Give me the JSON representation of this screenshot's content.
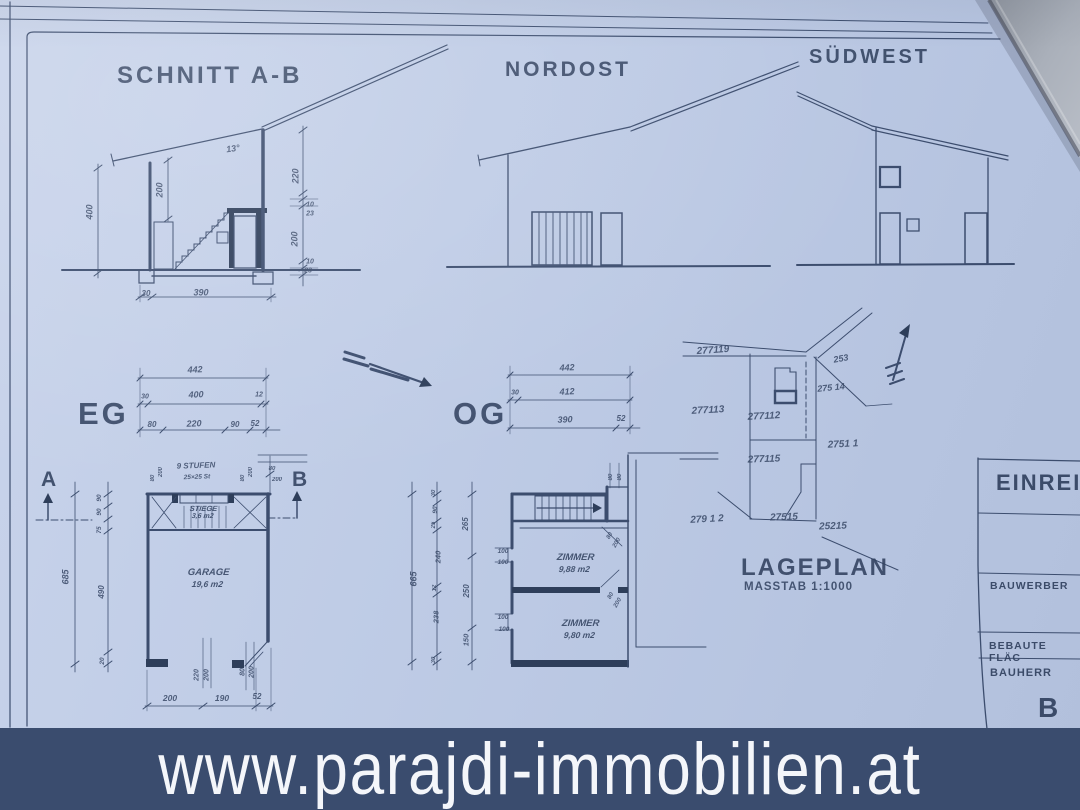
{
  "colors": {
    "paper": "#bfcce6",
    "ink": "#3c4d6e",
    "wall": "#2e3e5a",
    "banner_bg": "#3a4c6e",
    "banner_text": "#f4f6fa",
    "overlay_sheet": "#a7adb8"
  },
  "banner": {
    "url": "www.parajdi-immobilien.at"
  },
  "drawings": {
    "section": {
      "title": "SCHNITT A-B"
    },
    "nordost": {
      "title": "NORDOST"
    },
    "suedwest": {
      "title": "SÜDWEST"
    },
    "eg": {
      "title": "EG"
    },
    "og": {
      "title": "OG"
    },
    "lageplan": {
      "title": "LAGEPLAN",
      "scale": "MASSTAB 1:1000"
    }
  },
  "rooms": {
    "garage": {
      "name": "GARAGE",
      "area": "19,6 m2"
    },
    "stiege": {
      "name": "STIEGE",
      "area": "3,6 m2"
    },
    "zimmer1": {
      "name": "ZIMMER",
      "area": "9,88 m2"
    },
    "zimmer2": {
      "name": "ZIMMER",
      "area": "9,80 m2"
    }
  },
  "section_marks": {
    "a": "A",
    "b": "B"
  },
  "titleblock": {
    "header": "EINREIC",
    "bauwerber": "BAUWERBER",
    "bebaute": "BEBAUTE FLÄC",
    "bauherr": "BAUHERR",
    "partial_b": "B"
  },
  "annotations": [
    {
      "t": "13°",
      "x": 233,
      "y": 149,
      "r": -8,
      "s": 9
    },
    {
      "t": "400",
      "x": 90,
      "y": 212,
      "r": -90,
      "s": 9
    },
    {
      "t": "200",
      "x": 160,
      "y": 190,
      "r": -90,
      "s": 9
    },
    {
      "t": "220",
      "x": 296,
      "y": 176,
      "r": -90,
      "s": 9
    },
    {
      "t": "10",
      "x": 310,
      "y": 205,
      "r": 0,
      "s": 7
    },
    {
      "t": "23",
      "x": 310,
      "y": 214,
      "r": 0,
      "s": 7
    },
    {
      "t": "200",
      "x": 295,
      "y": 239,
      "r": -90,
      "s": 9
    },
    {
      "t": "10",
      "x": 310,
      "y": 262,
      "r": 0,
      "s": 7
    },
    {
      "t": "23",
      "x": 308,
      "y": 271,
      "r": 0,
      "s": 7
    },
    {
      "t": "30",
      "x": 146,
      "y": 294,
      "r": 0,
      "s": 8
    },
    {
      "t": "390",
      "x": 201,
      "y": 293,
      "r": 0,
      "s": 9
    },
    {
      "t": "442",
      "x": 195,
      "y": 370,
      "r": -2,
      "s": 9
    },
    {
      "t": "30",
      "x": 145,
      "y": 397,
      "r": 0,
      "s": 7
    },
    {
      "t": "400",
      "x": 196,
      "y": 395,
      "r": -2,
      "s": 9
    },
    {
      "t": "12",
      "x": 259,
      "y": 395,
      "r": 0,
      "s": 7
    },
    {
      "t": "80",
      "x": 152,
      "y": 425,
      "r": 0,
      "s": 8
    },
    {
      "t": "220",
      "x": 194,
      "y": 424,
      "r": -2,
      "s": 9
    },
    {
      "t": "90",
      "x": 235,
      "y": 425,
      "r": 0,
      "s": 8
    },
    {
      "t": "52",
      "x": 255,
      "y": 424,
      "r": 0,
      "s": 8
    },
    {
      "t": "9 STUFEN",
      "x": 196,
      "y": 466,
      "r": -2,
      "s": 8
    },
    {
      "t": "25×25 St",
      "x": 197,
      "y": 478,
      "r": -2,
      "s": 6.5
    },
    {
      "t": "80",
      "x": 153,
      "y": 478,
      "r": -90,
      "s": 6
    },
    {
      "t": "200",
      "x": 161,
      "y": 472,
      "r": -90,
      "s": 6
    },
    {
      "t": "80",
      "x": 243,
      "y": 478,
      "r": -90,
      "s": 6
    },
    {
      "t": "200",
      "x": 251,
      "y": 472,
      "r": -90,
      "s": 6
    },
    {
      "t": "80",
      "x": 272,
      "y": 469,
      "r": 0,
      "s": 6
    },
    {
      "t": "200",
      "x": 277,
      "y": 480,
      "r": 0,
      "s": 6
    },
    {
      "t": "685",
      "x": 66,
      "y": 577,
      "r": -90,
      "s": 9
    },
    {
      "t": "90",
      "x": 100,
      "y": 498,
      "r": -90,
      "s": 6.5
    },
    {
      "t": "90",
      "x": 100,
      "y": 512,
      "r": -90,
      "s": 6.5
    },
    {
      "t": "75",
      "x": 100,
      "y": 530,
      "r": -90,
      "s": 6.5
    },
    {
      "t": "490",
      "x": 102,
      "y": 592,
      "r": -90,
      "s": 8
    },
    {
      "t": "20",
      "x": 103,
      "y": 661,
      "r": -90,
      "s": 6.5
    },
    {
      "t": "220",
      "x": 197,
      "y": 675,
      "r": -90,
      "s": 7
    },
    {
      "t": "200",
      "x": 207,
      "y": 675,
      "r": -90,
      "s": 7
    },
    {
      "t": "80",
      "x": 243,
      "y": 672,
      "r": -90,
      "s": 7
    },
    {
      "t": "200",
      "x": 252,
      "y": 672,
      "r": -90,
      "s": 7
    },
    {
      "t": "200",
      "x": 170,
      "y": 698,
      "r": 0,
      "s": 8.5
    },
    {
      "t": "190",
      "x": 222,
      "y": 698,
      "r": 0,
      "s": 8.5
    },
    {
      "t": "52",
      "x": 257,
      "y": 697,
      "r": 0,
      "s": 8
    },
    {
      "t": "442",
      "x": 567,
      "y": 368,
      "r": -2,
      "s": 9
    },
    {
      "t": "30",
      "x": 515,
      "y": 393,
      "r": 0,
      "s": 7
    },
    {
      "t": "412",
      "x": 567,
      "y": 392,
      "r": -2,
      "s": 9
    },
    {
      "t": "390",
      "x": 565,
      "y": 420,
      "r": -2,
      "s": 9
    },
    {
      "t": "52",
      "x": 621,
      "y": 419,
      "r": 0,
      "s": 8
    },
    {
      "t": "665",
      "x": 414,
      "y": 579,
      "r": -90,
      "s": 9
    },
    {
      "t": "30",
      "x": 434,
      "y": 493,
      "r": -90,
      "s": 6
    },
    {
      "t": "90",
      "x": 436,
      "y": 510,
      "r": -90,
      "s": 6.5
    },
    {
      "t": "25",
      "x": 434,
      "y": 525,
      "r": -90,
      "s": 6
    },
    {
      "t": "265",
      "x": 466,
      "y": 524,
      "r": -90,
      "s": 8
    },
    {
      "t": "240",
      "x": 438,
      "y": 557,
      "r": -90,
      "s": 7.5
    },
    {
      "t": "12",
      "x": 435,
      "y": 588,
      "r": -90,
      "s": 6
    },
    {
      "t": "250",
      "x": 467,
      "y": 591,
      "r": -90,
      "s": 8
    },
    {
      "t": "238",
      "x": 436,
      "y": 617,
      "r": -90,
      "s": 7.5
    },
    {
      "t": "150",
      "x": 466,
      "y": 640,
      "r": -90,
      "s": 7.5
    },
    {
      "t": "30",
      "x": 434,
      "y": 660,
      "r": -90,
      "s": 6
    },
    {
      "t": "100",
      "x": 503,
      "y": 552,
      "r": 0,
      "s": 6.5
    },
    {
      "t": "100",
      "x": 503,
      "y": 563,
      "r": 0,
      "s": 6.5
    },
    {
      "t": "100",
      "x": 503,
      "y": 618,
      "r": 0,
      "s": 6.5
    },
    {
      "t": "100",
      "x": 504,
      "y": 630,
      "r": 0,
      "s": 6.5
    },
    {
      "t": "80",
      "x": 611,
      "y": 477,
      "r": -90,
      "s": 6
    },
    {
      "t": "80",
      "x": 620,
      "y": 477,
      "r": -90,
      "s": 6
    },
    {
      "t": "80",
      "x": 610,
      "y": 536,
      "r": -60,
      "s": 6
    },
    {
      "t": "200",
      "x": 617,
      "y": 543,
      "r": -60,
      "s": 6
    },
    {
      "t": "80",
      "x": 611,
      "y": 596,
      "r": -60,
      "s": 6
    },
    {
      "t": "200",
      "x": 618,
      "y": 603,
      "r": -60,
      "s": 6
    },
    {
      "t": "277119",
      "x": 713,
      "y": 351,
      "r": -4,
      "s": 10,
      "n": "parcel-label"
    },
    {
      "t": "253",
      "x": 841,
      "y": 359,
      "r": -10,
      "s": 9,
      "n": "parcel-label"
    },
    {
      "t": "275 14",
      "x": 831,
      "y": 388,
      "r": -6,
      "s": 9,
      "n": "parcel-label"
    },
    {
      "t": "277113",
      "x": 708,
      "y": 411,
      "r": -3,
      "s": 10,
      "n": "parcel-label"
    },
    {
      "t": "277112",
      "x": 764,
      "y": 417,
      "r": -3,
      "s": 10,
      "n": "parcel-label"
    },
    {
      "t": "2751 1",
      "x": 843,
      "y": 445,
      "r": -3,
      "s": 10,
      "n": "parcel-label"
    },
    {
      "t": "277115",
      "x": 764,
      "y": 460,
      "r": -2,
      "s": 10,
      "n": "parcel-label"
    },
    {
      "t": "279 1 2",
      "x": 707,
      "y": 520,
      "r": -3,
      "s": 10,
      "n": "parcel-label"
    },
    {
      "t": "27515",
      "x": 784,
      "y": 518,
      "r": -2,
      "s": 10,
      "n": "parcel-label"
    },
    {
      "t": "25215",
      "x": 833,
      "y": 527,
      "r": -2,
      "s": 10,
      "n": "parcel-label"
    }
  ]
}
